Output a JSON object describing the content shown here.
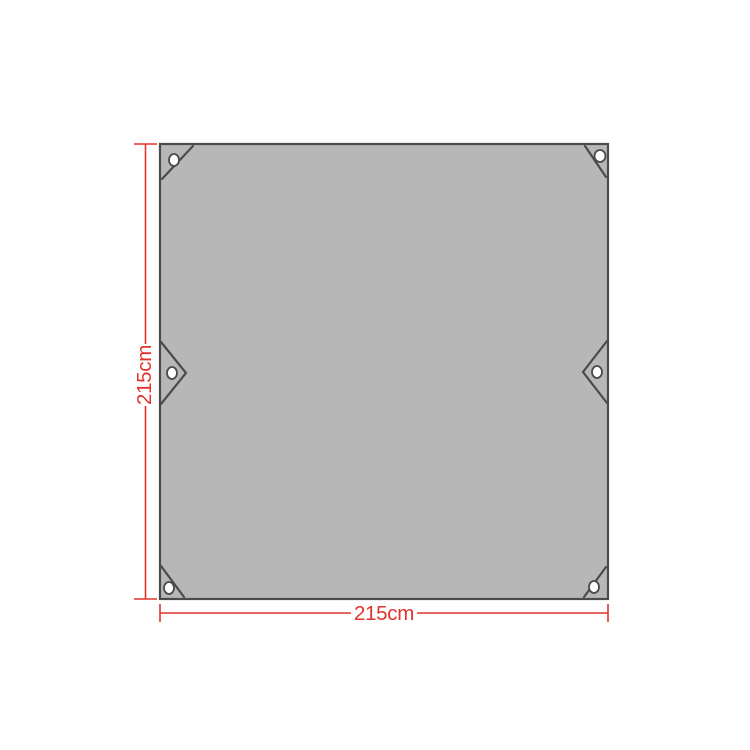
{
  "image": {
    "description": "Dimension diagram of a gray square tarp with corner grommets, corner reinforcement seams and two triangular side tie-tabs",
    "height_label": "215cm",
    "width_label": "215cm",
    "grommets": {
      "corner_count": 4,
      "side_tab_count": 2
    },
    "colors": {
      "background": "#ffffff",
      "tarp_fill": "#b7b7b7",
      "tarp_outline": "#4b4b4b",
      "dimension_red": "#e0342c",
      "grommet_fill": "#ffffff"
    }
  }
}
